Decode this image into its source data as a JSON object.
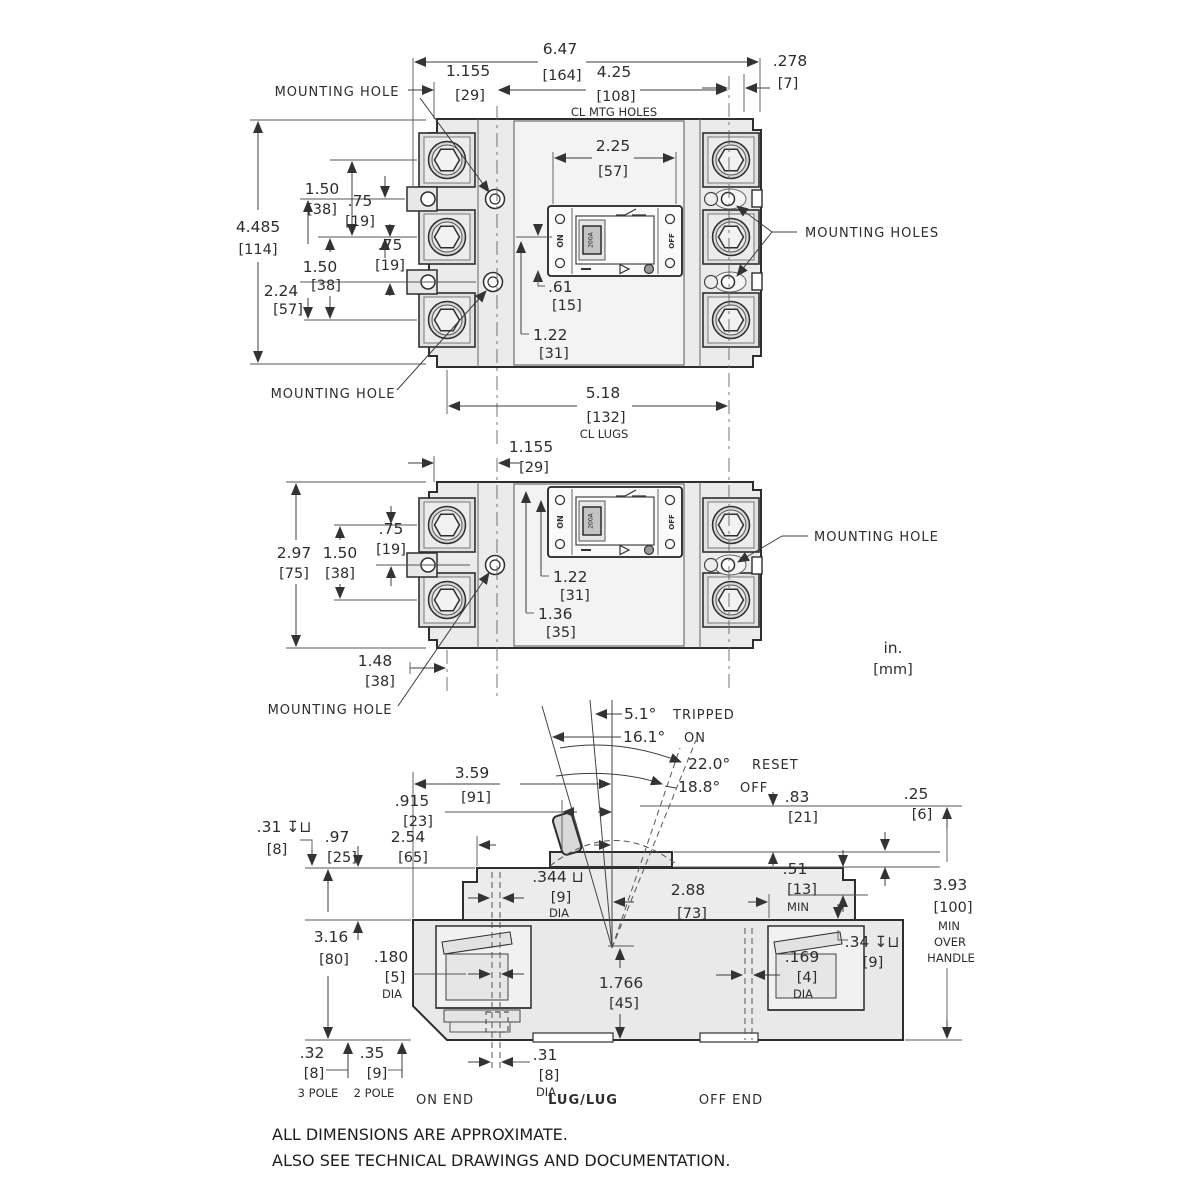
{
  "footer": {
    "line1": "ALL DIMENSIONS ARE APPROXIMATE.",
    "line2": "ALSO SEE TECHNICAL DRAWINGS AND DOCUMENTATION."
  },
  "units": {
    "inches": "in.",
    "mm": "[mm]"
  },
  "faceplate": {
    "on": "ON",
    "off": "OFF",
    "amp": "200A"
  },
  "top_view": {
    "overall_width": {
      "in": "6.47",
      "mm": "[164]"
    },
    "mtg_hole_offset": {
      "in": "1.155",
      "mm": "[29]"
    },
    "mtg_hole_span": {
      "in": "4.25",
      "mm": "[108]",
      "note": "CL MTG HOLES"
    },
    "edge_offset": {
      "in": ".278",
      "mm": "[7]"
    },
    "handle_window_width": {
      "in": "2.25",
      "mm": "[57]"
    },
    "overall_height": {
      "in": "4.485",
      "mm": "[114]"
    },
    "pole_pitch_top": {
      "in": "1.50",
      "mm": "[38]"
    },
    "hole_offset_top": {
      "in": ".75",
      "mm": "[19]"
    },
    "hole_offset_bottom": {
      "in": ".75",
      "mm": "[19]"
    },
    "pole_pitch_bottom": {
      "in": "1.50",
      "mm": "[38]"
    },
    "hole_to_lug": {
      "in": "2.24",
      "mm": "[57]"
    },
    "handle_offset": {
      "in": ".61",
      "mm": "[15]"
    },
    "faceplate_offset": {
      "in": "1.22",
      "mm": "[31]"
    },
    "lug_span": {
      "in": "5.18",
      "mm": "[132]",
      "note": "CL LUGS"
    },
    "mounting_hole_top_label": "MOUNTING HOLE",
    "mounting_hole_bottom_label": "MOUNTING HOLE",
    "mounting_holes_right_label": "MOUNTING HOLES"
  },
  "middle_view": {
    "mtg_hole_offset": {
      "in": "1.155",
      "mm": "[29]"
    },
    "hole_offset": {
      "in": ".75",
      "mm": "[19]"
    },
    "overall_height": {
      "in": "2.97",
      "mm": "[75]"
    },
    "pole_pitch": {
      "in": "1.50",
      "mm": "[38]"
    },
    "window_offset": {
      "in": "1.22",
      "mm": "[31]"
    },
    "faceplate_offset": {
      "in": "1.36",
      "mm": "[35]"
    },
    "lug_offset": {
      "in": "1.48",
      "mm": "[38]"
    },
    "mounting_hole_left_label": "MOUNTING HOLE",
    "mounting_hole_right_label": "MOUNTING HOLE"
  },
  "side_view": {
    "angle_tripped": {
      "value": "5.1°",
      "label": "TRIPPED"
    },
    "angle_on": {
      "value": "16.1°",
      "label": "ON"
    },
    "angle_reset": {
      "value": "22.0°",
      "label": "RESET"
    },
    "angle_off": {
      "value": "18.8°",
      "label": "OFF"
    },
    "handle_cl": {
      "in": "3.59",
      "mm": "[91]"
    },
    "handle_offset": {
      "in": ".915",
      "mm": "[23]"
    },
    "cover_height": {
      "in": ".97",
      "mm": "[25]"
    },
    "cover_width": {
      "in": "2.54",
      "mm": "[65]"
    },
    "recess_depth_left": {
      "in": ".31 ↧⊔",
      "mm": "[8]"
    },
    "handle_height": {
      "in": ".83",
      "mm": "[21]"
    },
    "cap_thickness": {
      "in": ".25",
      "mm": "[6]"
    },
    "clearance": {
      "in": ".51",
      "mm": "[13]",
      "note": "MIN"
    },
    "overall_height": {
      "in": "3.93",
      "mm": "[100]",
      "note1": "MIN",
      "note2": "OVER",
      "note3": "HANDLE"
    },
    "cbore_dia": {
      "in": ".344 ⊔",
      "mm": "[9]",
      "note": "DIA"
    },
    "base_width": {
      "in": "2.88",
      "mm": "[73]"
    },
    "body_height": {
      "in": "3.16",
      "mm": "[80]"
    },
    "hole_dia": {
      "in": ".180",
      "mm": "[5]",
      "note": "DIA"
    },
    "base_cl_height": {
      "in": "1.766",
      "mm": "[45]"
    },
    "recess_depth_right": {
      "in": ".34 ↧⊔",
      "mm": "[9]"
    },
    "hole_dia_right": {
      "in": ".169",
      "mm": "[4]",
      "note": "DIA"
    },
    "foot_3pole": {
      "in": ".32",
      "mm": "[8]",
      "note": "3 POLE"
    },
    "foot_2pole": {
      "in": ".35",
      "mm": "[9]",
      "note": "2 POLE"
    },
    "hole_dia_bottom": {
      "in": ".31",
      "mm": "[8]",
      "note": "DIA"
    },
    "on_end_label": "ON END",
    "lug_label": "LUG/LUG",
    "off_end_label": "OFF END"
  }
}
